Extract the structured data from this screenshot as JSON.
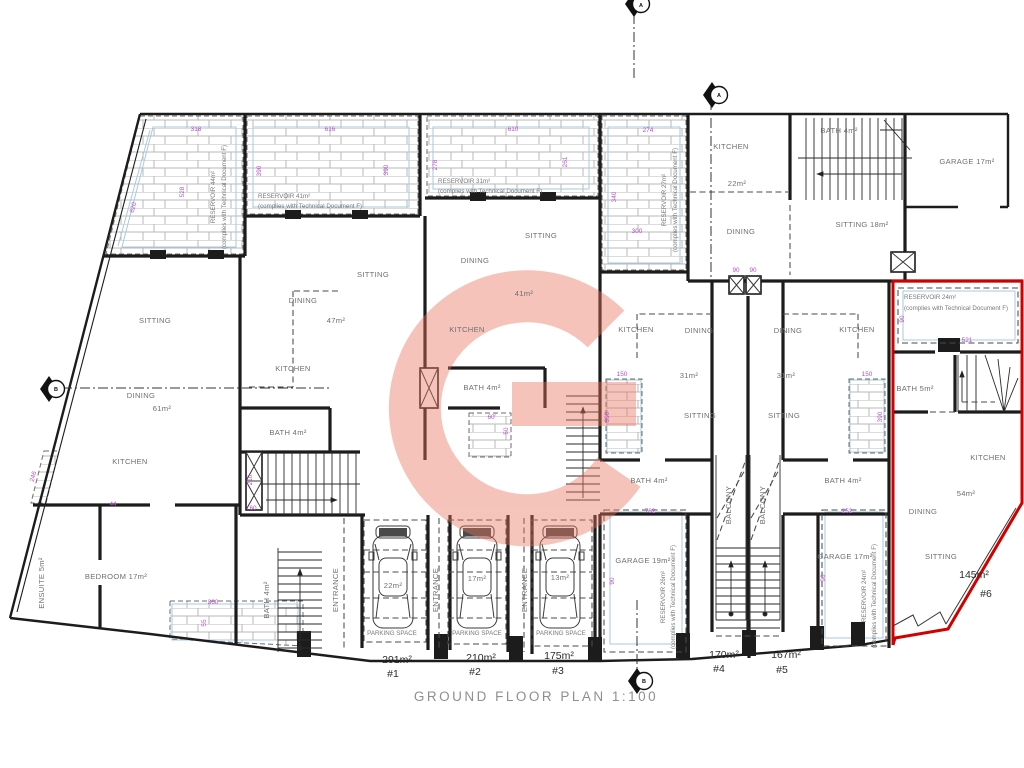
{
  "drawing": {
    "title": "GROUND FLOOR PLAN 1:100"
  },
  "colors": {
    "wall": "#1c1c1c",
    "red_outline": "#d10000",
    "dimension": "#b44fc8",
    "room_text": "#707070",
    "plot_text": "#2b2b2b",
    "blue_guide": "#a9cadc",
    "watermark": "#e8735c"
  },
  "labels": [
    {
      "t": "SITTING",
      "x": 155,
      "y": 323
    },
    {
      "t": "DINING",
      "x": 141,
      "y": 398
    },
    {
      "t": "61m²",
      "x": 162,
      "y": 411
    },
    {
      "t": "KITCHEN",
      "x": 130,
      "y": 464
    },
    {
      "t": "BEDROOM 17m²",
      "x": 116,
      "y": 579
    },
    {
      "t": "ENSUITE 5m²",
      "x": 44,
      "y": 583,
      "r": -90
    },
    {
      "t": "SITTING",
      "x": 373,
      "y": 277
    },
    {
      "t": "DINING",
      "x": 303,
      "y": 303
    },
    {
      "t": "47m²",
      "x": 336,
      "y": 323
    },
    {
      "t": "KITCHEN",
      "x": 293,
      "y": 371
    },
    {
      "t": "BATH 4m²",
      "x": 288,
      "y": 435
    },
    {
      "t": "SITTING",
      "x": 541,
      "y": 238
    },
    {
      "t": "DINING",
      "x": 475,
      "y": 263
    },
    {
      "t": "41m²",
      "x": 524,
      "y": 296
    },
    {
      "t": "KITCHEN",
      "x": 467,
      "y": 332
    },
    {
      "t": "BATH 4m²",
      "x": 482,
      "y": 390
    },
    {
      "t": "KITCHEN",
      "x": 636,
      "y": 332
    },
    {
      "t": "DINING",
      "x": 699,
      "y": 333
    },
    {
      "t": "31m²",
      "x": 689,
      "y": 378
    },
    {
      "t": "SITTING",
      "x": 700,
      "y": 418
    },
    {
      "t": "BATH 4m²",
      "x": 649,
      "y": 483
    },
    {
      "t": "DINING",
      "x": 788,
      "y": 333
    },
    {
      "t": "KITCHEN",
      "x": 857,
      "y": 332
    },
    {
      "t": "31m²",
      "x": 786,
      "y": 378
    },
    {
      "t": "SITTING",
      "x": 784,
      "y": 418
    },
    {
      "t": "BATH 4m²",
      "x": 843,
      "y": 483
    },
    {
      "t": "KITCHEN",
      "x": 731,
      "y": 149
    },
    {
      "t": "22m²",
      "x": 737,
      "y": 186
    },
    {
      "t": "DINING",
      "x": 741,
      "y": 234
    },
    {
      "t": "BATH 4m²",
      "x": 839,
      "y": 133
    },
    {
      "t": "SITTING 18m²",
      "x": 862,
      "y": 227
    },
    {
      "t": "GARAGE 17m²",
      "x": 967,
      "y": 164
    },
    {
      "t": "GARAGE 19m²",
      "x": 643,
      "y": 563
    },
    {
      "t": "GARAGE 17m²",
      "x": 845,
      "y": 559
    },
    {
      "t": "BATH 5m²",
      "x": 915,
      "y": 391
    },
    {
      "t": "KITCHEN",
      "x": 988,
      "y": 460
    },
    {
      "t": "54m²",
      "x": 966,
      "y": 496
    },
    {
      "t": "DINING",
      "x": 923,
      "y": 514
    },
    {
      "t": "SITTING",
      "x": 941,
      "y": 559
    },
    {
      "t": "BALCONY",
      "x": 731,
      "y": 505,
      "r": -90
    },
    {
      "t": "BALCONY",
      "x": 765,
      "y": 505,
      "r": -90
    },
    {
      "t": "ENTRANCE",
      "x": 338,
      "y": 590,
      "r": -90
    },
    {
      "t": "ENTRANCE",
      "x": 438,
      "y": 590,
      "r": -90
    },
    {
      "t": "ENTRANCE",
      "x": 527,
      "y": 590,
      "r": -90
    },
    {
      "t": "BATH 4m²",
      "x": 269,
      "y": 600,
      "r": -90
    },
    {
      "t": "22m²",
      "x": 393,
      "y": 588
    },
    {
      "t": "17m²",
      "x": 477,
      "y": 581
    },
    {
      "t": "13m²",
      "x": 560,
      "y": 580
    },
    {
      "t": "PARKING SPACE",
      "x": 392,
      "y": 635,
      "c": "res"
    },
    {
      "t": "PARKING SPACE",
      "x": 477,
      "y": 635,
      "c": "res"
    },
    {
      "t": "PARKING SPACE",
      "x": 561,
      "y": 635,
      "c": "res"
    },
    {
      "t": "RESERVOIR 44m²",
      "x": 215,
      "y": 197,
      "r": -90,
      "c": "res"
    },
    {
      "t": "(complies with Technical Document F)",
      "x": 226,
      "y": 197,
      "r": -90,
      "c": "res"
    },
    {
      "t": "RESERVOIR 41m²",
      "x": 258,
      "y": 198,
      "a": "s",
      "c": "res"
    },
    {
      "t": "(complies with Technical Document F)",
      "x": 258,
      "y": 208,
      "a": "s",
      "c": "res"
    },
    {
      "t": "RESERVOIR 31m²",
      "x": 438,
      "y": 183,
      "a": "s",
      "c": "res"
    },
    {
      "t": "(complies with Technical Document F)",
      "x": 438,
      "y": 193,
      "a": "s",
      "c": "res"
    },
    {
      "t": "RESERVOIR 27m²",
      "x": 666,
      "y": 200,
      "r": -90,
      "c": "res"
    },
    {
      "t": "(complies with Technical Document F)",
      "x": 677,
      "y": 200,
      "r": -90,
      "c": "res"
    },
    {
      "t": "RESERVOIR 26m²",
      "x": 665,
      "y": 597,
      "r": -90,
      "c": "res"
    },
    {
      "t": "(complies with Technical Document F)",
      "x": 675,
      "y": 597,
      "r": -90,
      "c": "res"
    },
    {
      "t": "RESERVOIR 24m²",
      "x": 866,
      "y": 596,
      "r": -90,
      "c": "res"
    },
    {
      "t": "(complies with Technical Document F)",
      "x": 876,
      "y": 596,
      "r": -90,
      "c": "res"
    },
    {
      "t": "RESERVOIR 24m²",
      "x": 904,
      "y": 299,
      "a": "s",
      "c": "res"
    },
    {
      "t": "(complies with Technical Document F)",
      "x": 904,
      "y": 310,
      "a": "s",
      "c": "res"
    },
    {
      "t": "318",
      "x": 196,
      "y": 131,
      "c": "dim"
    },
    {
      "t": "528",
      "x": 184,
      "y": 192,
      "r": -90,
      "c": "dim"
    },
    {
      "t": "620",
      "x": 135,
      "y": 208,
      "r": -75,
      "c": "dim"
    },
    {
      "t": "616",
      "x": 330,
      "y": 131,
      "c": "dim"
    },
    {
      "t": "390",
      "x": 261,
      "y": 171,
      "r": -90,
      "c": "dim"
    },
    {
      "t": "390",
      "x": 388,
      "y": 170,
      "r": -90,
      "c": "dim"
    },
    {
      "t": "610",
      "x": 513,
      "y": 131,
      "c": "dim"
    },
    {
      "t": "278",
      "x": 437,
      "y": 165,
      "r": -90,
      "c": "dim"
    },
    {
      "t": "261",
      "x": 567,
      "y": 162,
      "r": -90,
      "c": "dim"
    },
    {
      "t": "274",
      "x": 648,
      "y": 132,
      "c": "dim"
    },
    {
      "t": "340",
      "x": 616,
      "y": 197,
      "r": -90,
      "c": "dim"
    },
    {
      "t": "300",
      "x": 637,
      "y": 233,
      "c": "dim"
    },
    {
      "t": "150",
      "x": 622,
      "y": 376,
      "c": "dim"
    },
    {
      "t": "390",
      "x": 609,
      "y": 417,
      "r": -90,
      "c": "dim"
    },
    {
      "t": "150",
      "x": 867,
      "y": 376,
      "c": "dim"
    },
    {
      "t": "390",
      "x": 882,
      "y": 417,
      "r": -90,
      "c": "dim"
    },
    {
      "t": "210",
      "x": 252,
      "y": 480,
      "r": -90,
      "c": "dim"
    },
    {
      "t": "60",
      "x": 253,
      "y": 510,
      "c": "dim"
    },
    {
      "t": "60",
      "x": 491,
      "y": 419,
      "c": "dim"
    },
    {
      "t": "50",
      "x": 508,
      "y": 431,
      "r": -90,
      "c": "dim"
    },
    {
      "t": "762",
      "x": 650,
      "y": 513,
      "c": "dim"
    },
    {
      "t": "90",
      "x": 614,
      "y": 581,
      "r": -90,
      "c": "dim"
    },
    {
      "t": "252",
      "x": 847,
      "y": 513,
      "c": "dim"
    },
    {
      "t": "90",
      "x": 825,
      "y": 578,
      "r": -90,
      "c": "dim"
    },
    {
      "t": "521",
      "x": 967,
      "y": 342,
      "c": "dim"
    },
    {
      "t": "90",
      "x": 904,
      "y": 319,
      "r": -90,
      "c": "dim"
    },
    {
      "t": "360",
      "x": 213,
      "y": 604,
      "c": "dim"
    },
    {
      "t": "55",
      "x": 206,
      "y": 623,
      "r": -90,
      "c": "dim"
    },
    {
      "t": "246",
      "x": 35,
      "y": 477,
      "r": -75,
      "c": "dim"
    },
    {
      "t": "44",
      "x": 113,
      "y": 506,
      "c": "dim"
    },
    {
      "t": "90",
      "x": 736,
      "y": 272,
      "c": "dim"
    },
    {
      "t": "90",
      "x": 753,
      "y": 272,
      "c": "dim"
    },
    {
      "t": "291m²",
      "x": 397,
      "y": 663,
      "c": "plot",
      "n": "plot-area-1"
    },
    {
      "t": "#1",
      "x": 393,
      "y": 677,
      "c": "plot",
      "n": "plot-number-1"
    },
    {
      "t": "210m²",
      "x": 481,
      "y": 661,
      "c": "plot",
      "n": "plot-area-2"
    },
    {
      "t": "#2",
      "x": 475,
      "y": 675,
      "c": "plot",
      "n": "plot-number-2"
    },
    {
      "t": "175m²",
      "x": 559,
      "y": 659,
      "c": "plot",
      "n": "plot-area-3"
    },
    {
      "t": "#3",
      "x": 558,
      "y": 674,
      "c": "plot",
      "n": "plot-number-3"
    },
    {
      "t": "170m²",
      "x": 724,
      "y": 658,
      "c": "plot",
      "n": "plot-area-4"
    },
    {
      "t": "#4",
      "x": 719,
      "y": 672,
      "c": "plot",
      "n": "plot-number-4"
    },
    {
      "t": "167m²",
      "x": 786,
      "y": 658,
      "c": "plot",
      "n": "plot-area-5"
    },
    {
      "t": "#5",
      "x": 782,
      "y": 673,
      "c": "plot",
      "n": "plot-number-5"
    },
    {
      "t": "145m²",
      "x": 974,
      "y": 578,
      "c": "plot",
      "n": "plot-area-6"
    },
    {
      "t": "#6",
      "x": 986,
      "y": 597,
      "c": "plot",
      "n": "plot-number-6"
    },
    {
      "t": "A",
      "x": 719,
      "y": 97,
      "c": "mk",
      "n": "section-marker-letter"
    },
    {
      "t": "A",
      "x": 641,
      "y": 7,
      "c": "mk",
      "n": "section-marker-letter"
    },
    {
      "t": "B",
      "x": 56,
      "y": 391,
      "c": "mk",
      "n": "section-marker-letter"
    },
    {
      "t": "B",
      "x": 644,
      "y": 683,
      "c": "mk",
      "n": "section-marker-letter"
    }
  ]
}
